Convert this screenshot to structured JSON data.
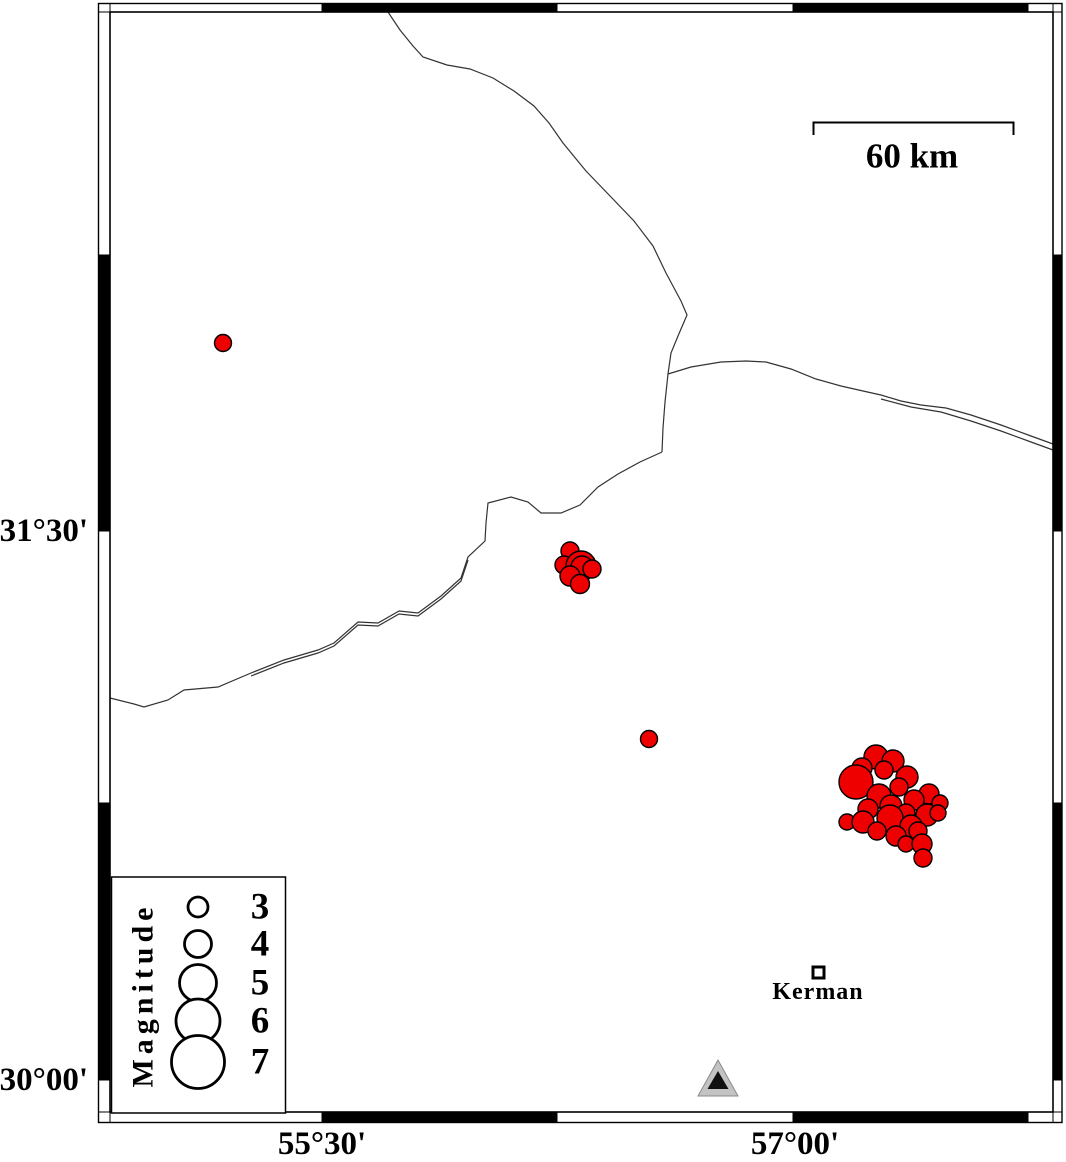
{
  "map": {
    "colors": {
      "earthquake_fill": "#ee0000",
      "marker_outline": "#000000",
      "fault_line": "#333333",
      "station_fill": "#c3c3c3",
      "station_edge": "#8a8a8a",
      "station_inner": "#111111",
      "frame_black": "#000000"
    },
    "scale_bar": {
      "label": "60 km"
    },
    "axes": {
      "left_labels": [
        {
          "text": "31°30'",
          "y": 531
        },
        {
          "text": "30°00'",
          "y": 1080
        }
      ],
      "bottom_labels": [
        {
          "text": "55°30'",
          "x": 322
        },
        {
          "text": "57°00'",
          "x": 795
        }
      ]
    },
    "legend": {
      "title": "Magnitude",
      "items": [
        {
          "label": "3",
          "y": 907,
          "r": 10
        },
        {
          "label": "4",
          "y": 944,
          "r": 13.5
        },
        {
          "label": "5",
          "y": 983,
          "r": 18.5
        },
        {
          "label": "6",
          "y": 1021,
          "r": 22
        },
        {
          "label": "7",
          "y": 1062,
          "r": 26.5
        }
      ]
    },
    "city": {
      "name": "Kerman",
      "x": 818,
      "y": 972
    },
    "station": {
      "x": 718,
      "y": 1080
    },
    "frame": {
      "outer": {
        "x": 98.5,
        "y": 3.5,
        "w": 963.5,
        "h": 1119
      },
      "inner": {
        "x": 110,
        "y": 12,
        "w": 943,
        "h": 1100
      },
      "x_ticks": [
        110,
        322,
        557,
        793,
        1028,
        1053
      ],
      "y_ticks": [
        12,
        255,
        531,
        803,
        1080,
        1112
      ],
      "black_x": [
        [
          322,
          557
        ],
        [
          793,
          1028
        ]
      ],
      "black_y": [
        [
          255,
          531
        ],
        [
          803,
          1080
        ]
      ]
    },
    "faults": [
      {
        "points": "388,12 400,30 413,46 423,57 447,65 470,69 493,78 514,91 534,106 549,123 563,143 586,171 611,197 634,221 653,246 666,273 681,301 687,315 678,336 671,353 668,374 665,402 663,428 662,452"
      },
      {
        "points": "662,452 640,462 618,474 598,487 580,505 561,513 541,513 528,502 511,497 488,503 486,523 485,541 468,557 461,578 441,596 418,613 399,611 378,623 358,622 334,643 318,650 284,660 251,673 218,687 184,690 168,700 144,707 134,704 110,698"
      },
      {
        "points": "251,676 284,663 318,653 334,646 358,625 378,626 399,614 418,616 441,599 461,581 468,560"
      },
      {
        "points": "668,374 691,367 721,362 746,361 766,362 791,369 816,379 841,386 863,391 881,395 901,401 921,405 946,408 971,415 1001,425 1031,436 1053,444"
      },
      {
        "points": "881,399 911,407 941,412 971,421 1001,431 1031,442 1053,450"
      }
    ],
    "earthquakes": [
      {
        "x": 223,
        "y": 343,
        "r": 8.5
      },
      {
        "x": 649,
        "y": 739,
        "r": 8.5
      },
      {
        "x": 570,
        "y": 551,
        "r": 9
      },
      {
        "x": 564,
        "y": 565,
        "r": 9
      },
      {
        "x": 581,
        "y": 566,
        "r": 15
      },
      {
        "x": 582,
        "y": 567,
        "r": 11
      },
      {
        "x": 570,
        "y": 576,
        "r": 10
      },
      {
        "x": 580,
        "y": 584,
        "r": 9.5
      },
      {
        "x": 592,
        "y": 569,
        "r": 9
      },
      {
        "x": 876,
        "y": 757,
        "r": 12
      },
      {
        "x": 893,
        "y": 761,
        "r": 11
      },
      {
        "x": 862,
        "y": 768,
        "r": 10
      },
      {
        "x": 884,
        "y": 770,
        "r": 9
      },
      {
        "x": 907,
        "y": 777,
        "r": 11
      },
      {
        "x": 856,
        "y": 782,
        "r": 17
      },
      {
        "x": 899,
        "y": 787,
        "r": 9
      },
      {
        "x": 929,
        "y": 794,
        "r": 10
      },
      {
        "x": 879,
        "y": 796,
        "r": 12
      },
      {
        "x": 914,
        "y": 800,
        "r": 10
      },
      {
        "x": 940,
        "y": 803,
        "r": 8
      },
      {
        "x": 868,
        "y": 809,
        "r": 10
      },
      {
        "x": 891,
        "y": 806,
        "r": 11
      },
      {
        "x": 906,
        "y": 813,
        "r": 9
      },
      {
        "x": 927,
        "y": 815,
        "r": 11
      },
      {
        "x": 847,
        "y": 822,
        "r": 8
      },
      {
        "x": 863,
        "y": 822,
        "r": 11
      },
      {
        "x": 890,
        "y": 818,
        "r": 13
      },
      {
        "x": 911,
        "y": 826,
        "r": 11
      },
      {
        "x": 938,
        "y": 813,
        "r": 8
      },
      {
        "x": 877,
        "y": 831,
        "r": 9
      },
      {
        "x": 896,
        "y": 836,
        "r": 10
      },
      {
        "x": 918,
        "y": 831,
        "r": 9
      },
      {
        "x": 906,
        "y": 844,
        "r": 8
      },
      {
        "x": 922,
        "y": 844,
        "r": 10
      },
      {
        "x": 923,
        "y": 858,
        "r": 9
      }
    ]
  }
}
